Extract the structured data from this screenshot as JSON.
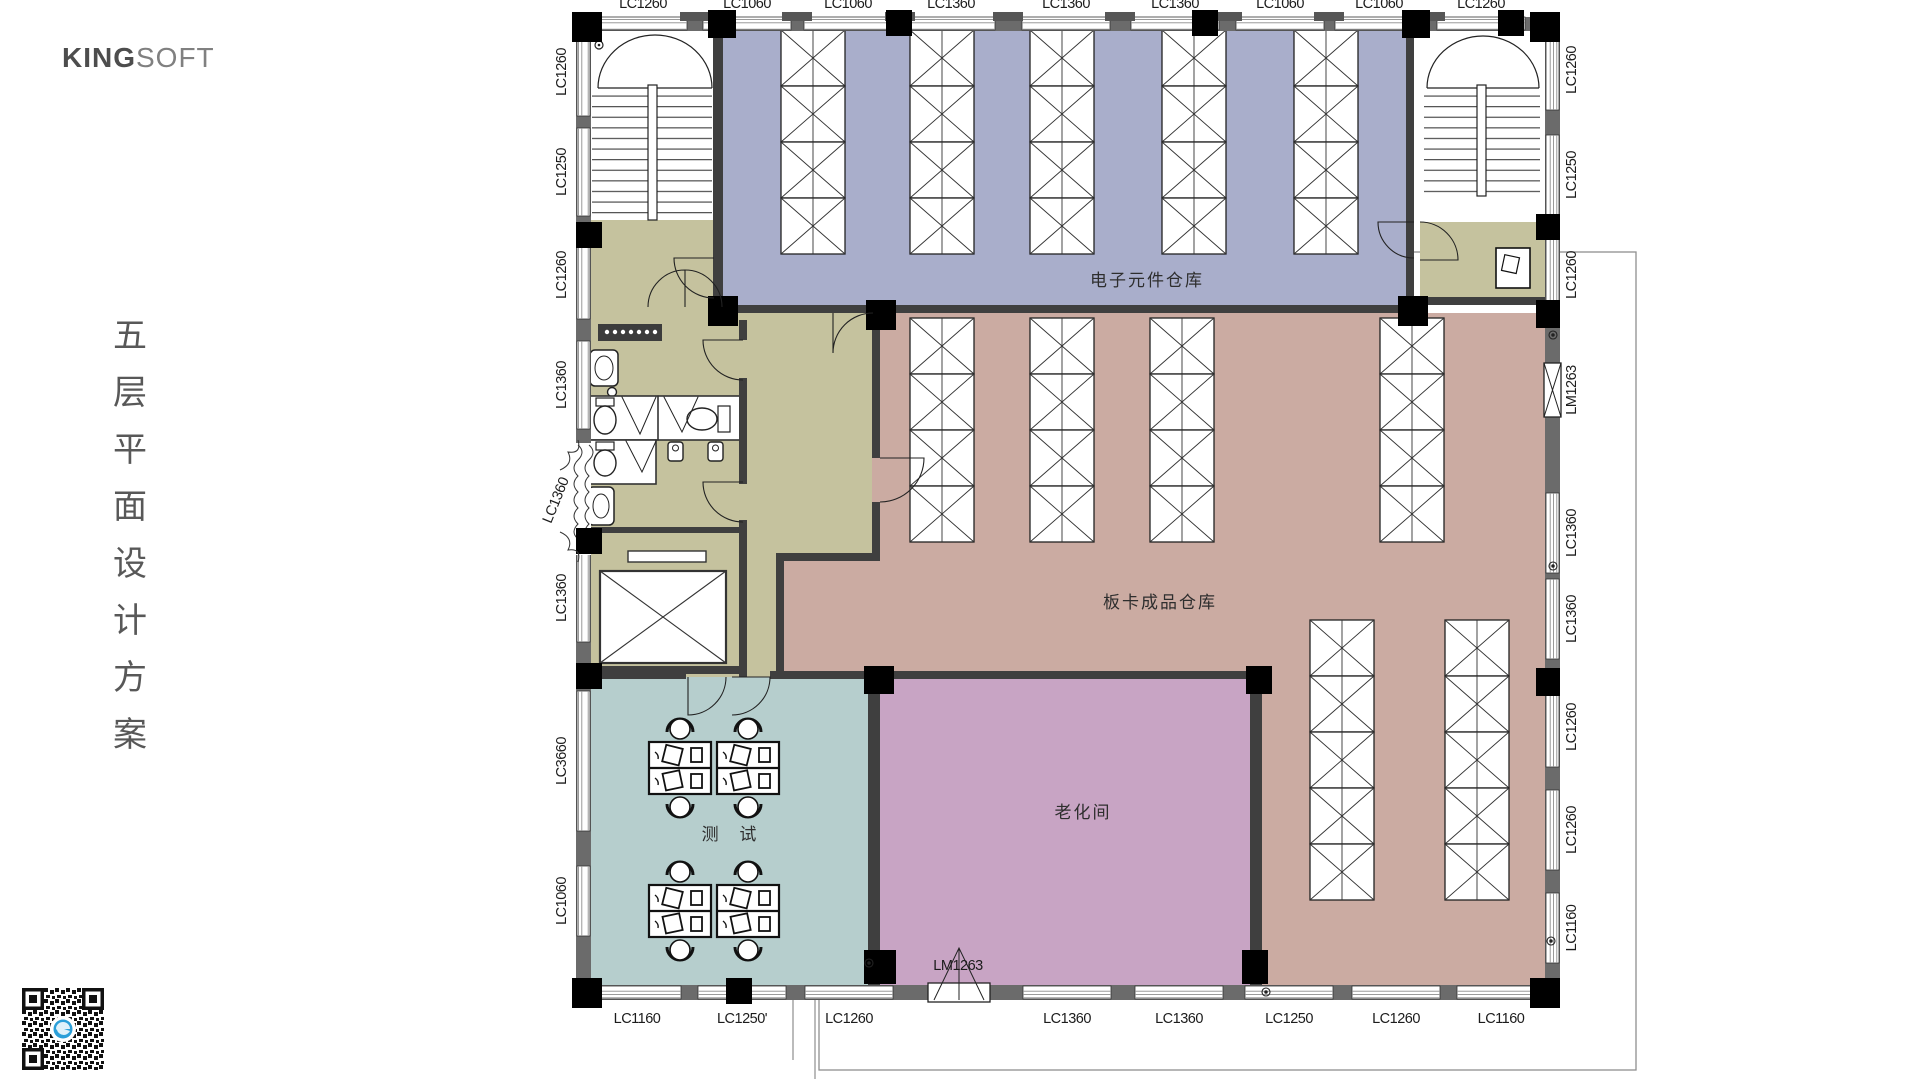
{
  "brand": {
    "name_bold": "KING",
    "name_light": "SOFT"
  },
  "slide_title": {
    "text": "五层平面设计方案",
    "chars": [
      "五",
      "层",
      "平",
      "面",
      "设",
      "计",
      "方",
      "案"
    ]
  },
  "rooms": {
    "electronics_warehouse": {
      "label": "电子元件仓库",
      "color": "#a9aecb"
    },
    "board_warehouse": {
      "label": "板卡成品仓库",
      "color": "#cbaba2"
    },
    "aging_room": {
      "label": "老化间",
      "color": "#c8a4c4"
    },
    "test_room": {
      "label": "测 试",
      "color": "#b6cecd"
    }
  },
  "zones": {
    "corridor_color": "#c5c29e",
    "wall_color": "#3f3f3f"
  },
  "dims": {
    "top": [
      "LC1260",
      "LC1060",
      "LC1060",
      "LC1360",
      "LC1360",
      "LC1360",
      "LC1060",
      "LC1060",
      "LC1260"
    ],
    "left": [
      "LC1260",
      "LC1250",
      "LC1260",
      "LC1360",
      "LC1360",
      "LC1360",
      "LC3660",
      "LC1060"
    ],
    "right": [
      "LC1260",
      "LC1250",
      "LC1260",
      "LM1263",
      "LC1360",
      "LC1360",
      "LC1260",
      "LC1260",
      "LC1160"
    ],
    "bottom": [
      "LC1160",
      "LC1250'",
      "LC1260",
      "LM1263",
      "LC1360",
      "LC1360",
      "LC1250",
      "LC1260",
      "LC1160"
    ]
  }
}
